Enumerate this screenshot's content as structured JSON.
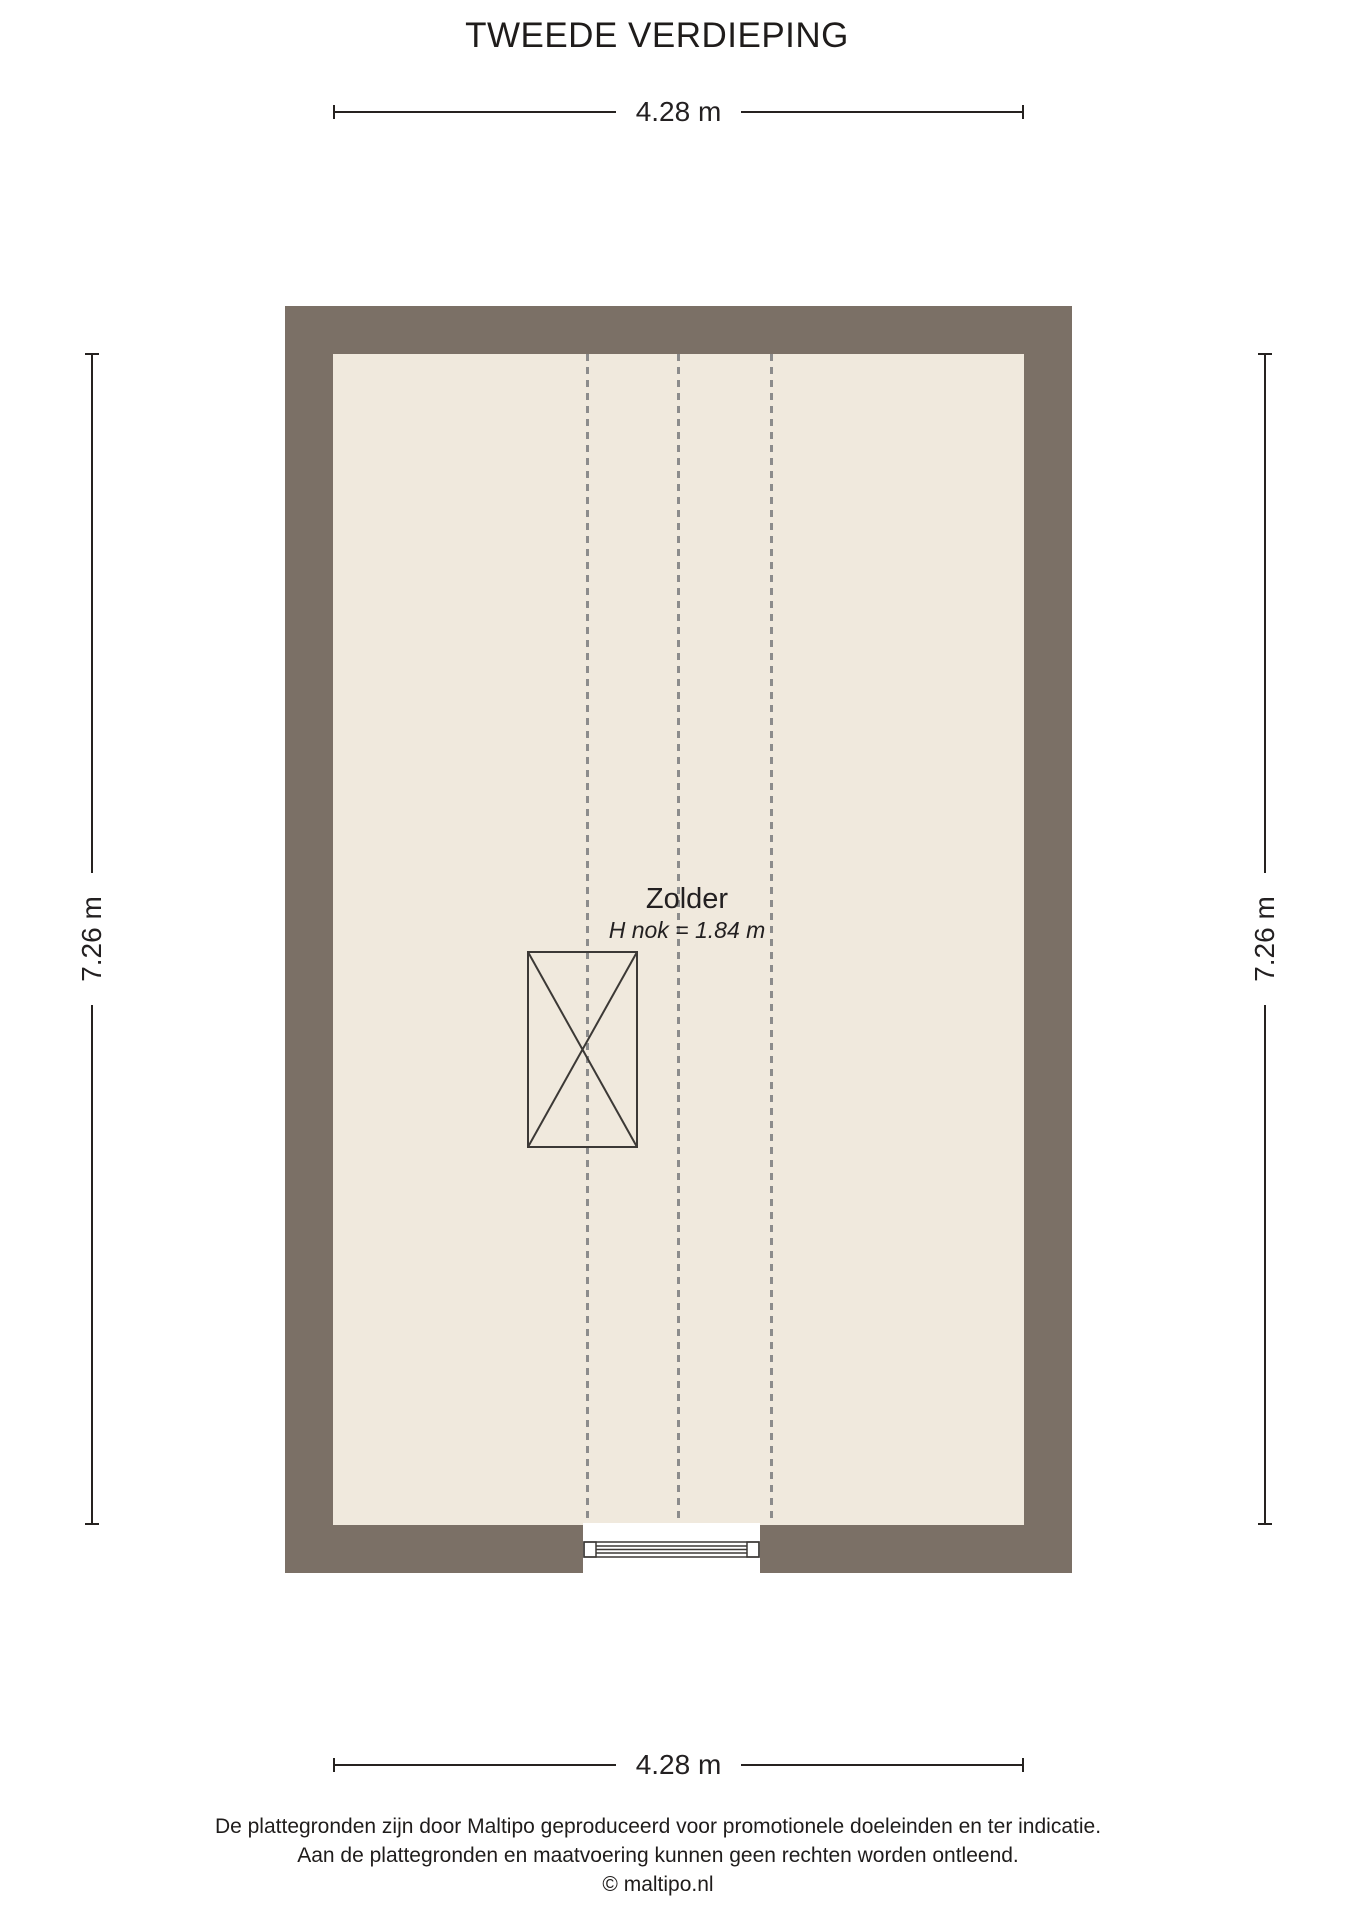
{
  "page": {
    "title": "TWEEDE VERDIEPING"
  },
  "plan": {
    "room": {
      "name": "Zolder",
      "ridge_height_label": "H nok = 1.84 m"
    },
    "symbols": {
      "void_symbol": "crossed-rectangle-stair-void",
      "window_symbol": "window-in-bottom-wall",
      "roof_slope_lines": "three-vertical-dashed-lines"
    }
  },
  "dimensions": {
    "top_width": "4.28 m",
    "bottom_width": "4.28 m",
    "left_height": "7.26 m",
    "right_height": "7.26 m"
  },
  "footer": {
    "disclaimer_line1": "De plattegronden zijn door Maltipo geproduceerd voor promotionele doeleinden en ter indicatie.",
    "disclaimer_line2": "Aan de plattegronden en maatvoering kunnen geen rechten worden ontleend.",
    "copyright": "© maltipo.nl"
  },
  "colors": {
    "wall": "#7b7066",
    "floor": "#f0e9dd",
    "dashed_line": "#8c8c8c",
    "dimension": "#262220",
    "symbol_stroke": "#3c3936"
  }
}
